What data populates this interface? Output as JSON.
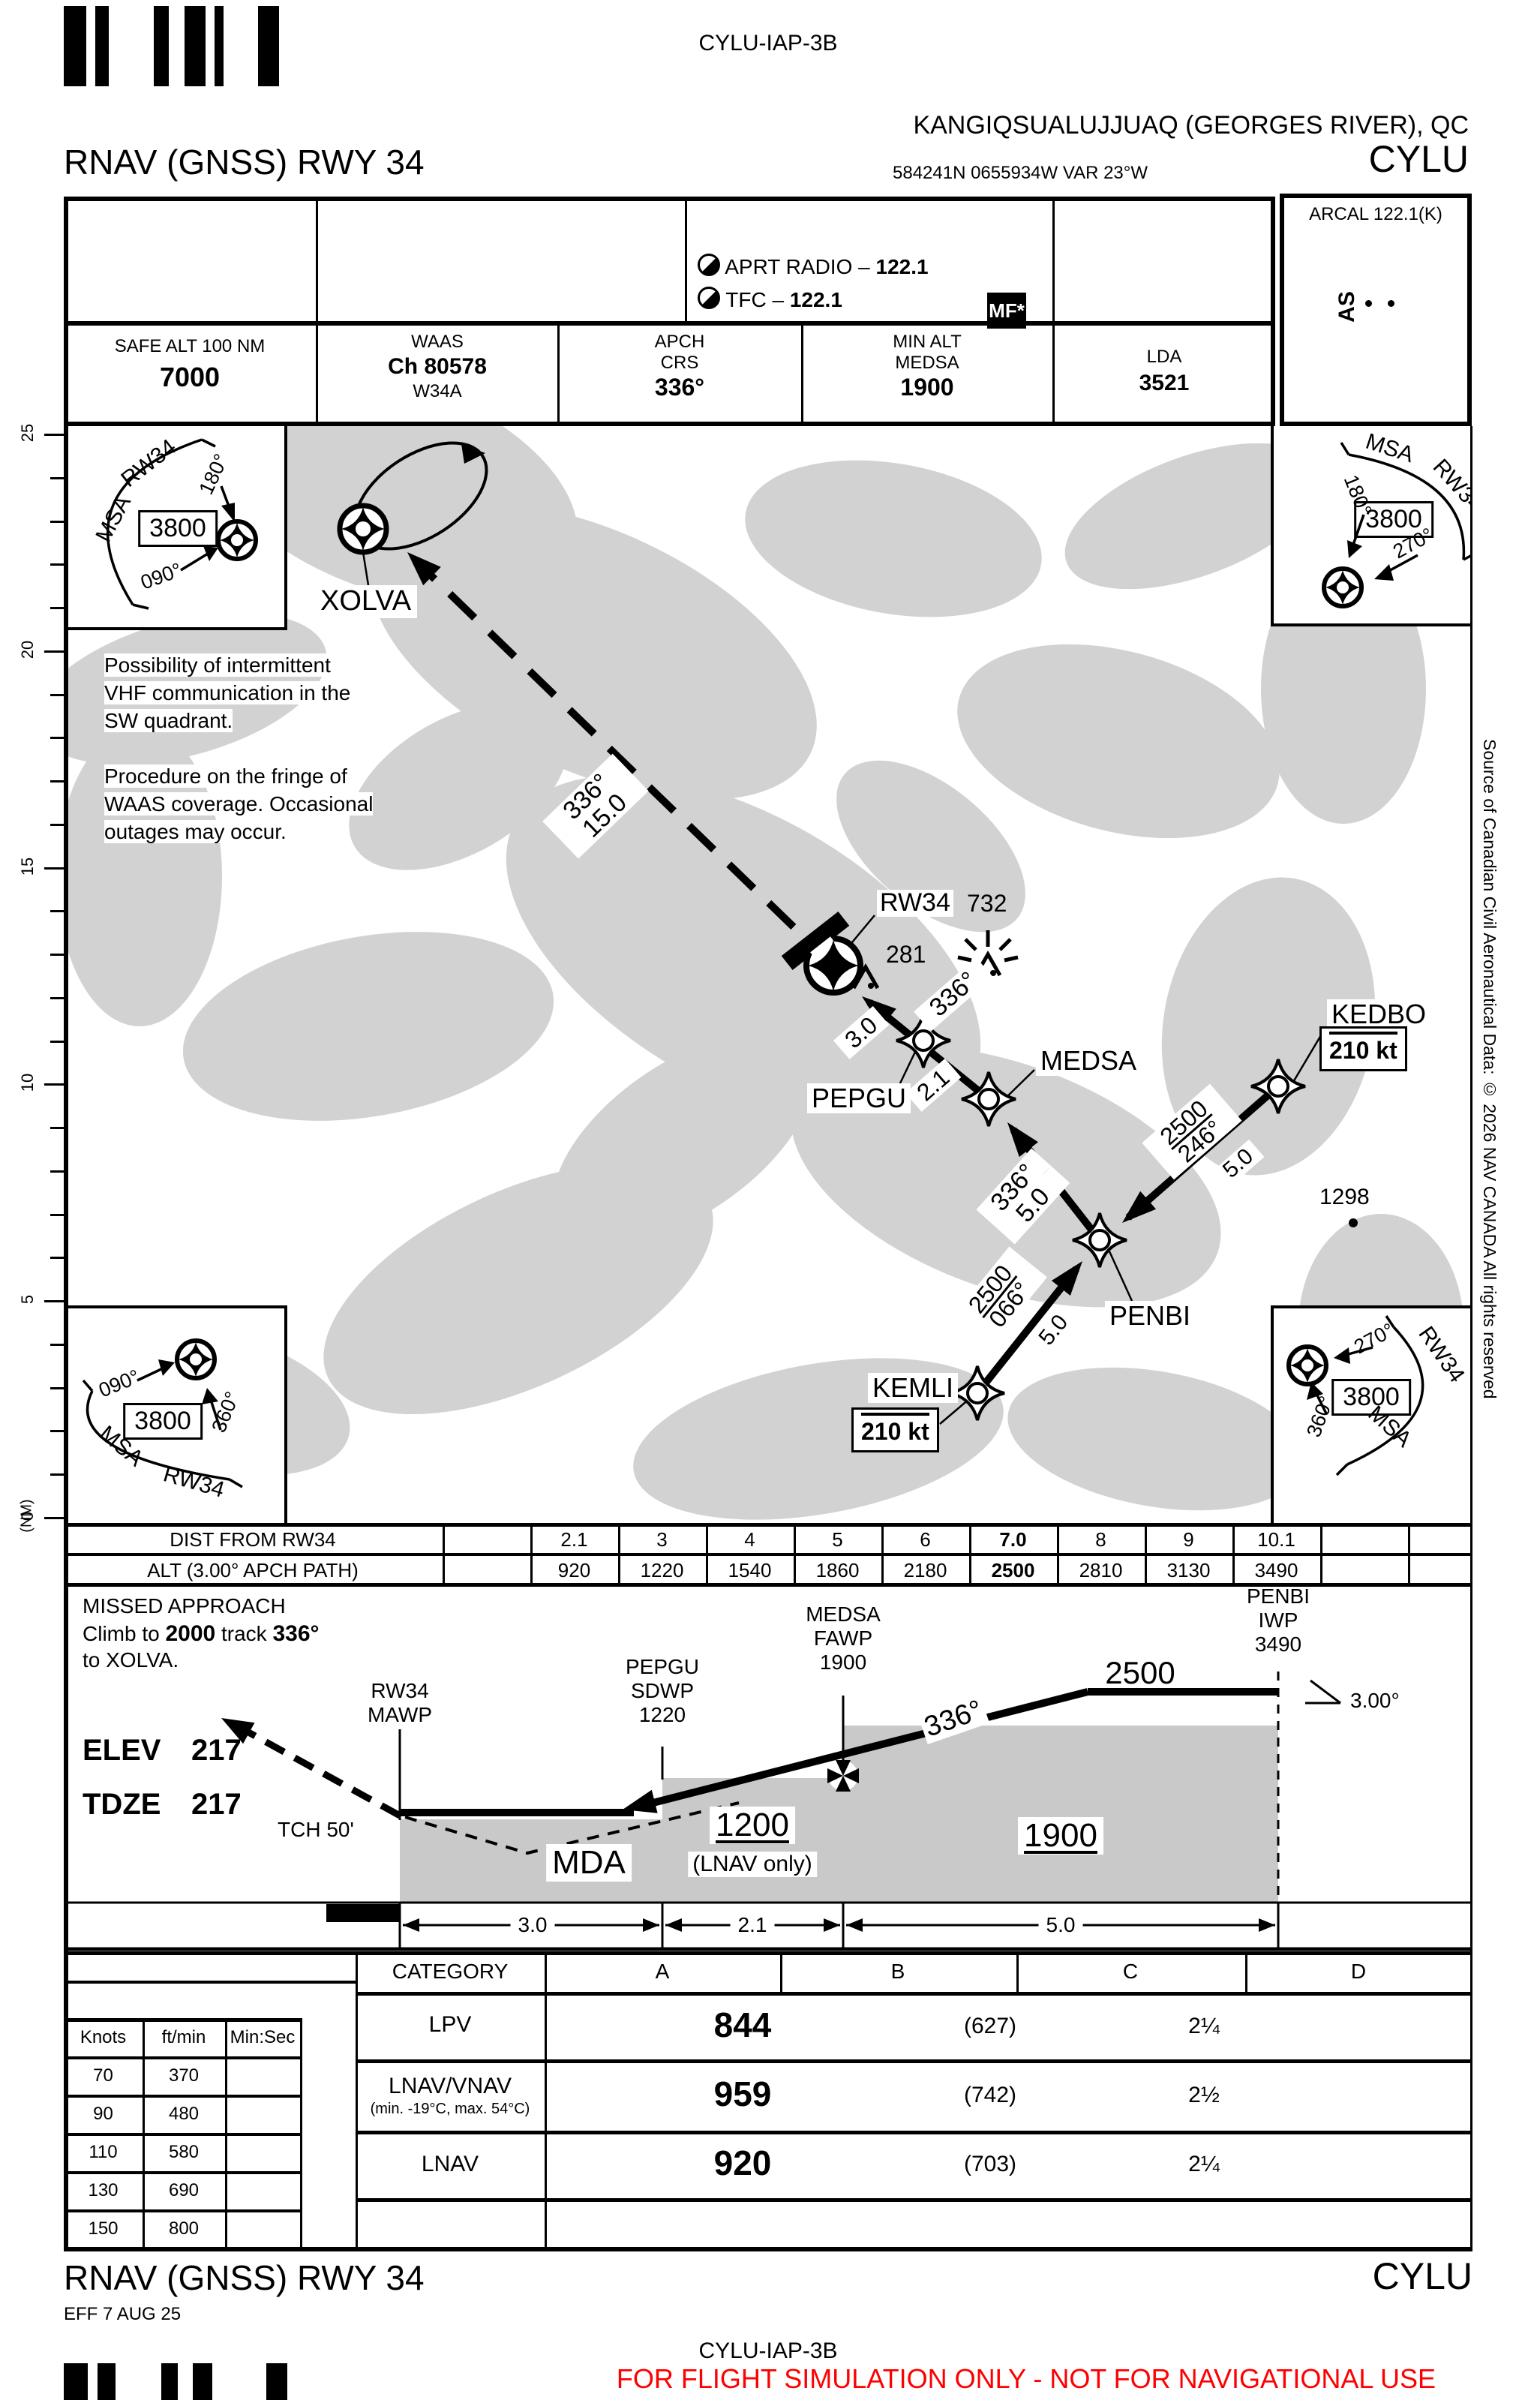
{
  "doc": {
    "chart_id_top": "CYLU-IAP-3B",
    "chart_id_bottom": "CYLU-IAP-3B",
    "airport": "KANGIQSUALUJJUAQ (GEORGES RIVER), QC",
    "procedure": "RNAV (GNSS) RWY 34",
    "procedure_footer": "RNAV (GNSS) RWY 34",
    "icao": "CYLU",
    "icao_footer": "CYLU",
    "coords": "584241N  0655934W  VAR 23°W",
    "effective": "EFF 7 AUG 25",
    "warning": "FOR FLIGHT SIMULATION ONLY - NOT FOR NAVIGATIONAL USE",
    "attribution": "Source of Canadian Civil Aeronautical Data: © 2026 NAV CANADA All rights reserved"
  },
  "comms": {
    "aprt_radio_label": "APRT RADIO –",
    "aprt_radio_freq": "122.1",
    "tfc_label": "TFC –",
    "tfc_freq": "122.1",
    "mf_badge": "MF*",
    "arcal": "ARCAL 122.1(K)",
    "as_label": "AS"
  },
  "info": {
    "safe_alt_label": "SAFE ALT 100 NM",
    "safe_alt": "7000",
    "waas_label": "WAAS",
    "waas_channel": "Ch 80578",
    "waas_id": "W34A",
    "apch_label1": "APCH",
    "apch_label2": "CRS",
    "apch_crs": "336°",
    "minalt_label1": "MIN ALT",
    "minalt_label2": "MEDSA",
    "min_alt": "1900",
    "lda_label": "LDA",
    "lda": "3521"
  },
  "msa": {
    "tl": {
      "msa": "MSA",
      "rwy": "RW34",
      "alt": "3800",
      "brg1": "180°",
      "brg2": "090°"
    },
    "tr": {
      "msa": "MSA",
      "rwy": "RW34",
      "alt": "3800",
      "brg1": "180°",
      "brg2": "270°"
    },
    "bl": {
      "msa": "MSA",
      "rwy": "RW34",
      "alt": "3800",
      "brg1": "090°",
      "brg2": "360°"
    },
    "br": {
      "msa": "MSA",
      "rwy": "RW34",
      "alt": "3800",
      "brg1": "270°",
      "brg2": "360°"
    }
  },
  "plan": {
    "xolva": "XOLVA",
    "rw34": "RW34",
    "pepgu": "PEPGU",
    "medsa": "MEDSA",
    "penbi": "PENBI",
    "kemli": "KEMLI",
    "kedbo": "KEDBO",
    "obstacle1": "281",
    "obstacle2": "732",
    "spot_elev": "1298",
    "kemli_speed": "210 kt",
    "kedbo_speed": "210 kt",
    "leg_ma_crs": "336°",
    "leg_ma_dist": "15.0",
    "leg_final_crs": "336°",
    "leg_pepgu_dist": "3.0",
    "leg_medsa_dist": "2.1",
    "leg_penbi_crs": "336°",
    "leg_penbi_dist": "5.0",
    "leg_kemli_alt": "2500",
    "leg_kemli_crs": "066°",
    "leg_kemli_dist": "5.0",
    "leg_kedbo_alt": "2500",
    "leg_kedbo_crs": "246°",
    "leg_kedbo_dist": "5.0",
    "note1_l1": "Possibility of intermittent",
    "note1_l2": "VHF communication in the",
    "note1_l3": "SW quadrant.",
    "note2_l1": "Procedure on the fringe of",
    "note2_l2": "WAAS coverage. Occasional",
    "note2_l3": "outages may occur."
  },
  "scale": {
    "unit": "(NM)",
    "labels": [
      "0",
      "5",
      "10",
      "15",
      "20",
      "25"
    ]
  },
  "dist_table": {
    "row1_label": "DIST FROM RW34",
    "row2_label": "ALT (3.00° APCH PATH)",
    "distances": [
      "2.1",
      "3",
      "4",
      "5",
      "6",
      "7.0",
      "8",
      "9",
      "10.1"
    ],
    "altitudes": [
      "920",
      "1220",
      "1540",
      "1860",
      "2180",
      "2500",
      "2810",
      "3130",
      "3490"
    ],
    "bold_index": 5
  },
  "profile": {
    "ma_l1": "MISSED APPROACH",
    "ma_l2a": "Climb to ",
    "ma_l2b": "2000",
    "ma_l2c": " track ",
    "ma_l2d": "336°",
    "ma_l3": "to XOLVA.",
    "rw34_l1": "RW34",
    "rw34_l2": "MAWP",
    "pepgu_l1": "PEPGU",
    "pepgu_l2": "SDWP",
    "pepgu_alt": "1220",
    "medsa_l1": "MEDSA",
    "medsa_l2": "FAWP",
    "medsa_alt": "1900",
    "penbi_l1": "PENBI",
    "penbi_l2": "IWP",
    "penbi_alt": "3490",
    "level_alt": "2500",
    "angle": "3.00°",
    "crs": "336°",
    "mda": "MDA",
    "step_alt": "1200",
    "step_note": "(LNAV only)",
    "fawp_block_alt": "1900",
    "elev_label": "ELEV",
    "elev": "217",
    "tdze_label": "TDZE",
    "tdze": "217",
    "tch": "TCH 50'",
    "seg1": "3.0",
    "seg2": "2.1",
    "seg3": "5.0"
  },
  "minima": {
    "header": [
      "CATEGORY",
      "A",
      "B",
      "C",
      "D"
    ],
    "rows": [
      {
        "label": "LPV",
        "sub": "",
        "da": "844",
        "hat": "(627)",
        "vis": "2¼"
      },
      {
        "label": "LNAV/VNAV",
        "sub": "(min. -19°C, max. 54°C)",
        "da": "959",
        "hat": "(742)",
        "vis": "2½"
      },
      {
        "label": "LNAV",
        "sub": "",
        "da": "920",
        "hat": "(703)",
        "vis": "2¼"
      }
    ]
  },
  "speed_table": {
    "headers": [
      "Knots",
      "ft/min",
      "Min:Sec"
    ],
    "rows": [
      [
        "70",
        "370",
        ""
      ],
      [
        "90",
        "480",
        ""
      ],
      [
        "110",
        "580",
        ""
      ],
      [
        "130",
        "690",
        ""
      ],
      [
        "150",
        "800",
        ""
      ]
    ]
  }
}
